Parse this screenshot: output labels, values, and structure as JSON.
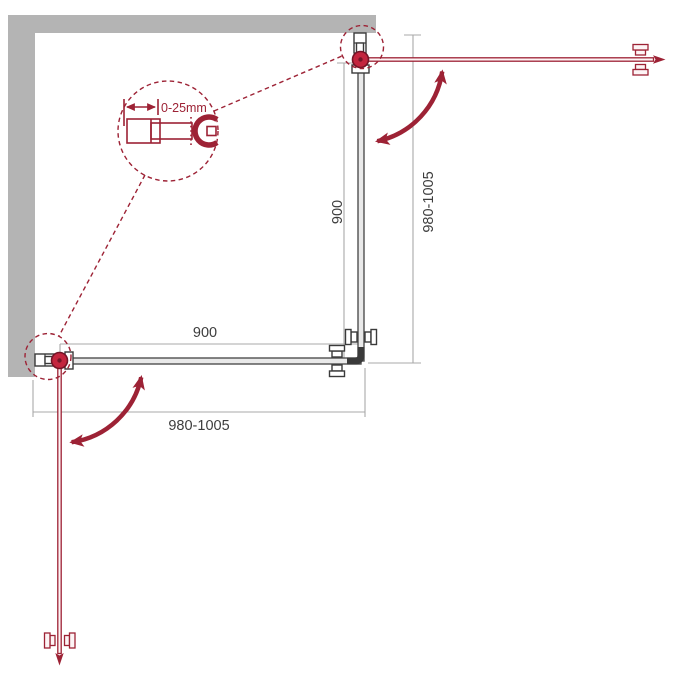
{
  "diagram": {
    "title": "corner shower enclosure installation scheme",
    "colors": {
      "accent_red": "#9d2235",
      "hinge_red": "#c3253e",
      "hinge_dark": "#731426",
      "wall_gray": "#b4b4b4",
      "dim_gray": "#a8a8a8",
      "glass_dark": "#4f4f4f",
      "text_color": "#3d3d3d"
    },
    "dimensions": {
      "door_width_bottom": "900",
      "overall_width_bottom": "980-1005",
      "door_width_right": "900",
      "overall_depth_right": "980-1005"
    },
    "callout": {
      "adjustment_label": "0-25mm"
    }
  }
}
